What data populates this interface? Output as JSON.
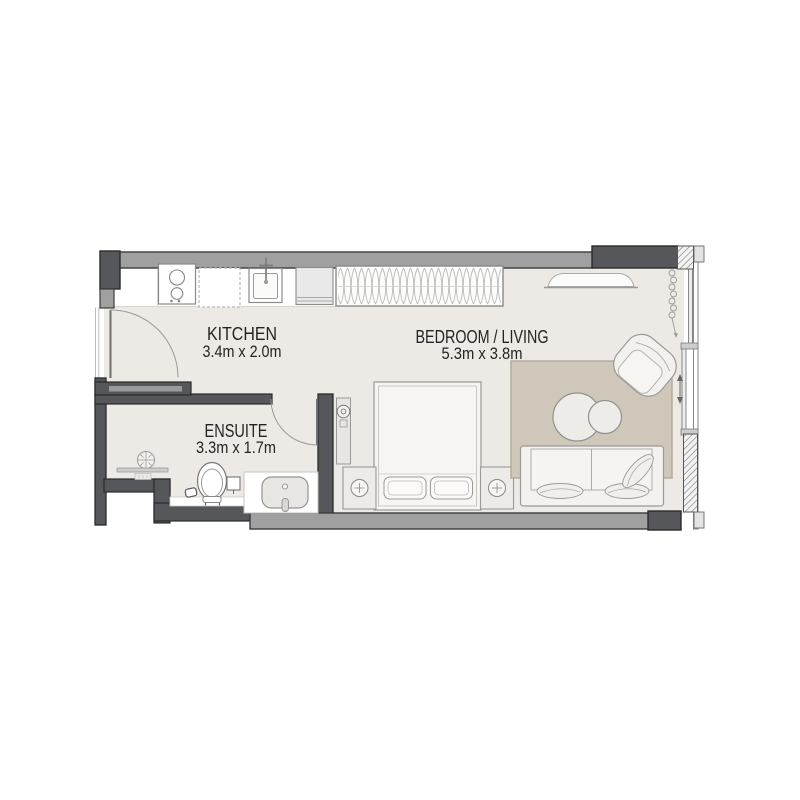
{
  "plan": {
    "type": "studio-apartment-floor-plan",
    "rooms": [
      {
        "name": "KITCHEN",
        "dimensions": "3.4m x 2.0m"
      },
      {
        "name": "BEDROOM / LIVING",
        "dimensions": "5.3m x 3.8m"
      },
      {
        "name": "ENSUITE",
        "dimensions": "3.3m x 1.7m"
      }
    ],
    "fixtures": [
      "entry-door",
      "ensuite-door",
      "cooktop-2-burner",
      "kitchen-counter",
      "kitchen-sink-with-faucet",
      "appliance-unit",
      "wardrobe-hanging-rail",
      "ceiling-light",
      "curtain-coil",
      "sliding-glazed-wall",
      "double-bed",
      "pillows",
      "nightstand-left",
      "nightstand-right",
      "bedside-lamps",
      "wall-mounted-unit",
      "area-rug",
      "round-coffee-tables",
      "sofa",
      "sofa-cushions",
      "armchair",
      "shower-floor-drain",
      "shower-screen",
      "toilet",
      "flush-plate",
      "waste-bin",
      "vanity-counter",
      "vanity-basin"
    ],
    "colors": {
      "background": "#ffffff",
      "floor": "#edeae5",
      "counter_white": "#ffffff",
      "wall_gray": "#a0a0a0",
      "wall_dark": "#55575a",
      "wall_outline": "#2e2e30",
      "rug": "#cfc8ba",
      "rug_border": "#b3ab9d",
      "furniture_fill": "#f4f2ee",
      "line_gray": "#999999",
      "text": "#232323"
    }
  }
}
